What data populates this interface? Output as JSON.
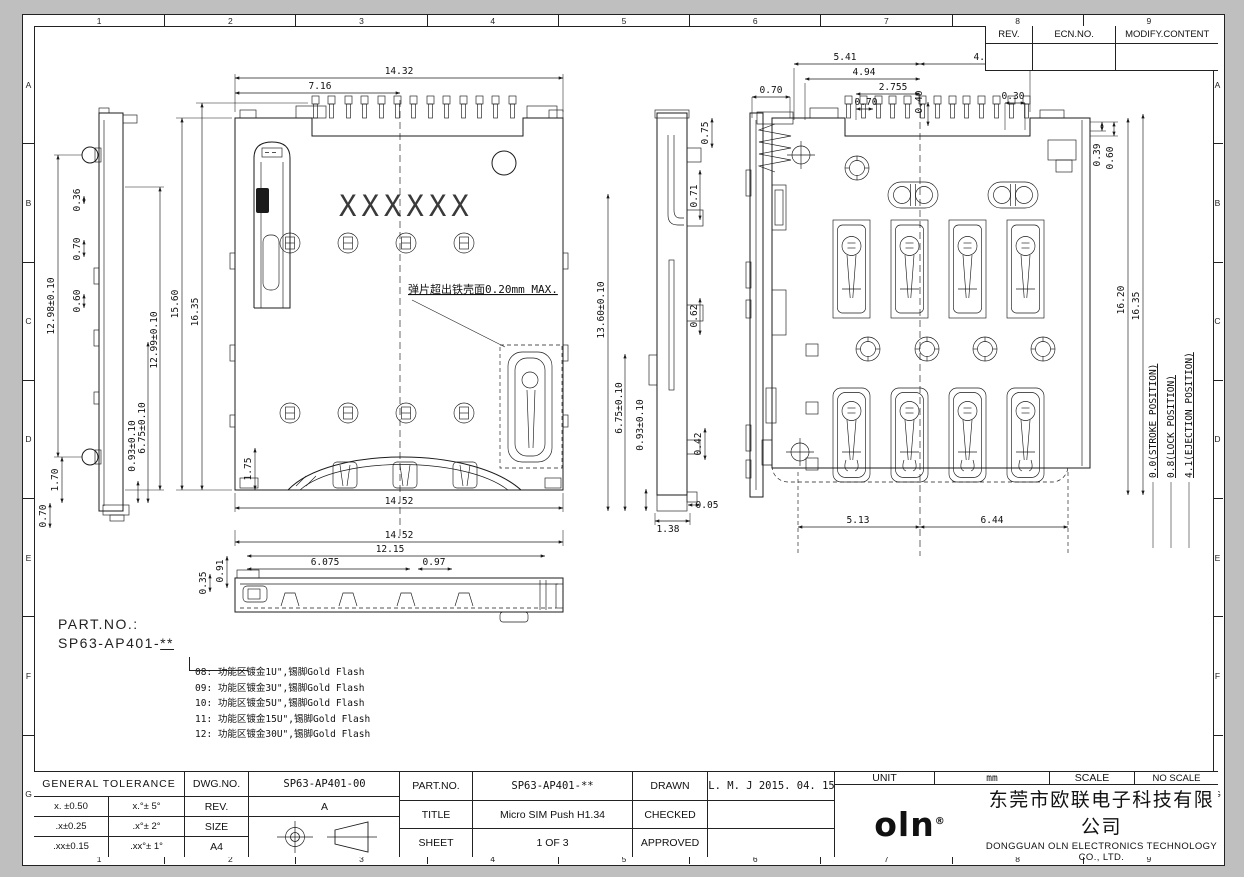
{
  "sheet": {
    "zone_cols": [
      "1",
      "2",
      "3",
      "4",
      "5",
      "6",
      "7",
      "8",
      "9"
    ],
    "zone_rows": [
      "A",
      "B",
      "C",
      "D",
      "E",
      "F",
      "G"
    ]
  },
  "rev_table": {
    "headers": [
      "REV.",
      "ECN.NO.",
      "MODIFY.CONTENT"
    ]
  },
  "drawing": {
    "marking": "XXXXXX",
    "spring_note": "弹片超出铁壳面0.20mm MAX.",
    "dims": {
      "left_view": {
        "overall": "12.98±0.10",
        "tab1": "0.36",
        "tab2": "0.70",
        "tab3": "0.60",
        "inner": "12.99±0.10",
        "foot1": "0.93±0.10",
        "foot2": "6.75±0.10",
        "lug": "1.70",
        "base": "0.70"
      },
      "front_view": {
        "width": "14.32",
        "half_width": "7.16",
        "height": "15.60",
        "height_total": "16.35",
        "bottom_width": "14.52",
        "corner": "1.75"
      },
      "profile_view": {
        "w1": "14.52",
        "w2": "12.15",
        "w3": "6.075",
        "w4": "0.97",
        "h1": "0.91",
        "h2": "0.35"
      },
      "section_view": {
        "p1": "0.75",
        "p2": "0.71",
        "p3": "0.62",
        "p4": "0.42",
        "h1": "13.60±0.10",
        "h2": "6.75±0.10",
        "h3": "0.93±0.10",
        "gap": "0.05",
        "base": "1.38"
      },
      "bottom_view": {
        "t1": "5.41",
        "t2": "4.94",
        "t3": "2.755",
        "t4": "0.70",
        "t5": "0.40",
        "t6": "0.30",
        "t7": "4.70",
        "t8": "0.70",
        "r1": "0.39",
        "r2": "0.60",
        "r3": "16.20",
        "r4": "16.35",
        "b1": "5.13",
        "b2": "6.44"
      },
      "positions": [
        "0.0(STROKE POSITION)",
        "0.8(LOCK POSITION)",
        "4.1(EJECTION POSITION)"
      ]
    }
  },
  "part_block": {
    "label": "PART.NO.:",
    "prefix": "SP63-AP401-",
    "suffix": "**",
    "options": [
      "08: 功能区镀金1U\",锡脚Gold Flash",
      "09: 功能区镀金3U\",锡脚Gold Flash",
      "10: 功能区镀金5U\",锡脚Gold Flash",
      "11: 功能区镀金15U\",锡脚Gold Flash",
      "12: 功能区镀金30U\",锡脚Gold Flash"
    ]
  },
  "title_block": {
    "general_header": "GENERAL  TOLERANCE",
    "tol_rows": [
      {
        "lin": "x. ±0.50",
        "ang": "x.°± 5°"
      },
      {
        "lin": ".x±0.25",
        "ang": ".x°± 2°"
      },
      {
        "lin": ".xx±0.15",
        "ang": ".xx°± 1°"
      }
    ],
    "dwg_no_label": "DWG.NO.",
    "dwg_no": "SP63-AP401-00",
    "rev_label": "REV.",
    "rev": "A",
    "size_label": "SIZE",
    "size": "A4",
    "part_no_label": "PART.NO.",
    "part_no": "SP63-AP401-**",
    "title_label": "TITLE",
    "title": "Micro SIM Push H1.34",
    "sheet_label": "SHEET",
    "sheet": "1 OF 3",
    "drawn_label": "DRAWN",
    "drawn": "L. M. J 2015. 04. 15",
    "checked_label": "CHECKED",
    "checked": "",
    "approved_label": "APPROVED",
    "approved": "",
    "unit_label": "UNIT",
    "unit": "mm",
    "scale_label": "SCALE",
    "scale": "NO SCALE",
    "logo": "oln",
    "logo_reg": "®",
    "company_cn": "东莞市欧联电子科技有限公司",
    "company_en": "DONGGUAN OLN ELECTRONICS TECHNOLOGY CO., LTD."
  }
}
